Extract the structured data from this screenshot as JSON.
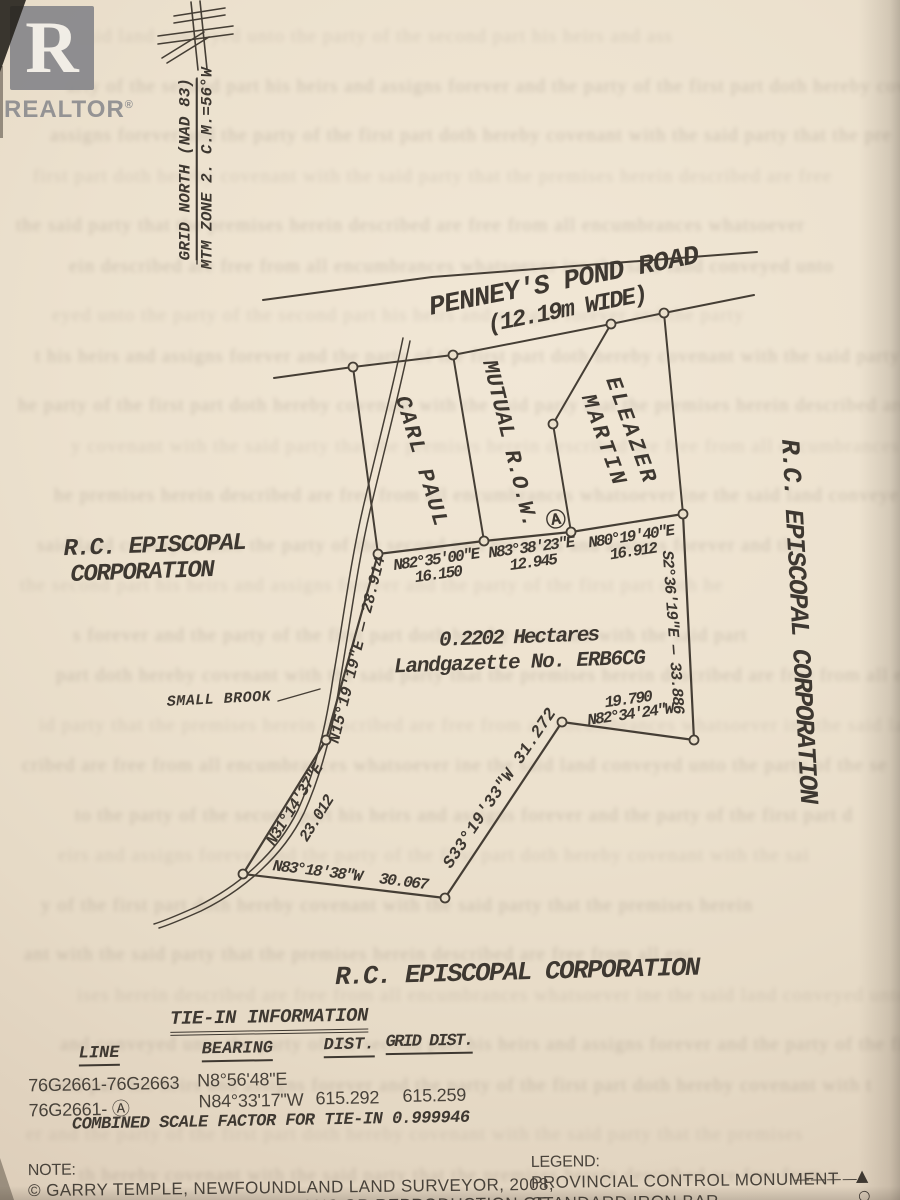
{
  "watermark": {
    "letter": "R",
    "label": "REALTOR",
    "registered": "®"
  },
  "north_arrow": {
    "line1": "GRID NORTH (NAD 83)",
    "line2": "MTM ZONE 2. C.M.=56°W"
  },
  "road": {
    "name": "PENNEY'S POND ROAD",
    "width": "(12.19m WIDE)"
  },
  "owners": {
    "carl_paul": "CARL PAUL",
    "mutual_row": "MUTUAL R.O.W.",
    "eleazer1": "ELEAZER",
    "eleazer2": "MARTIN",
    "west1": "R.C. EPISCOPAL",
    "west2": "CORPORATION",
    "east": "R.C. EPISCOPAL CORPORATION",
    "south": "R.C. EPISCOPAL CORPORATION"
  },
  "parcel": {
    "area": "0.2202 Hectares",
    "gazette": "Landgazette No. ERB6CG",
    "monument": "Ⓐ"
  },
  "bearings": {
    "n1b": "N82°35'00\"E",
    "n1d": "16.150",
    "n2b": "N83°38'23\"E",
    "n2d": "12.945",
    "n3b": "N80°19'40\"E",
    "n3d": "16.912",
    "east": "S2°36'19\"E — 33.886",
    "sed": "19.790",
    "seb": "N82°34'24\"W",
    "swdiag": "S33°19'33\"W 31.272",
    "southb": "N83°18'38\"W",
    "southd": "30.067",
    "w1b": "N31°14'37\"E",
    "w1d": "23.012",
    "w2": "N15°19'19\"E — 28.914"
  },
  "brook": "SMALL BROOK",
  "tie_in": {
    "title": "TIE-IN INFORMATION",
    "col_line": "LINE",
    "col_bearing": "BEARING",
    "col_dist": "DIST.",
    "col_grid": "GRID DIST.",
    "rows": [
      {
        "line": "76G2661-76G2663",
        "bearing": "N8°56'48\"E",
        "dist": "",
        "grid": ""
      },
      {
        "line": "76G2661- Ⓐ",
        "bearing": "N84°33'17\"W",
        "dist": "615.292",
        "grid": "615.259"
      }
    ],
    "footer": "COMBINED SCALE FACTOR FOR TIE-IN 0.999946"
  },
  "note": {
    "heading": "NOTE:",
    "line1": "© GARRY TEMPLE, NEWFOUNDLAND LAND SURVEYOR, 2008,",
    "line2": "UNAUTHORIZED USE, ALTERATIONS OR REPRODUCTION OF"
  },
  "legend": {
    "heading": "LEGEND:",
    "item1_label": "PROVINCIAL CONTROL MONUMENT",
    "item1_dashes": "— — — —",
    "item1_symbol": "▲",
    "item2_label": "STANDARD IRON BAR",
    "item2_dashes": "— — — —",
    "item2_symbol": "○"
  }
}
